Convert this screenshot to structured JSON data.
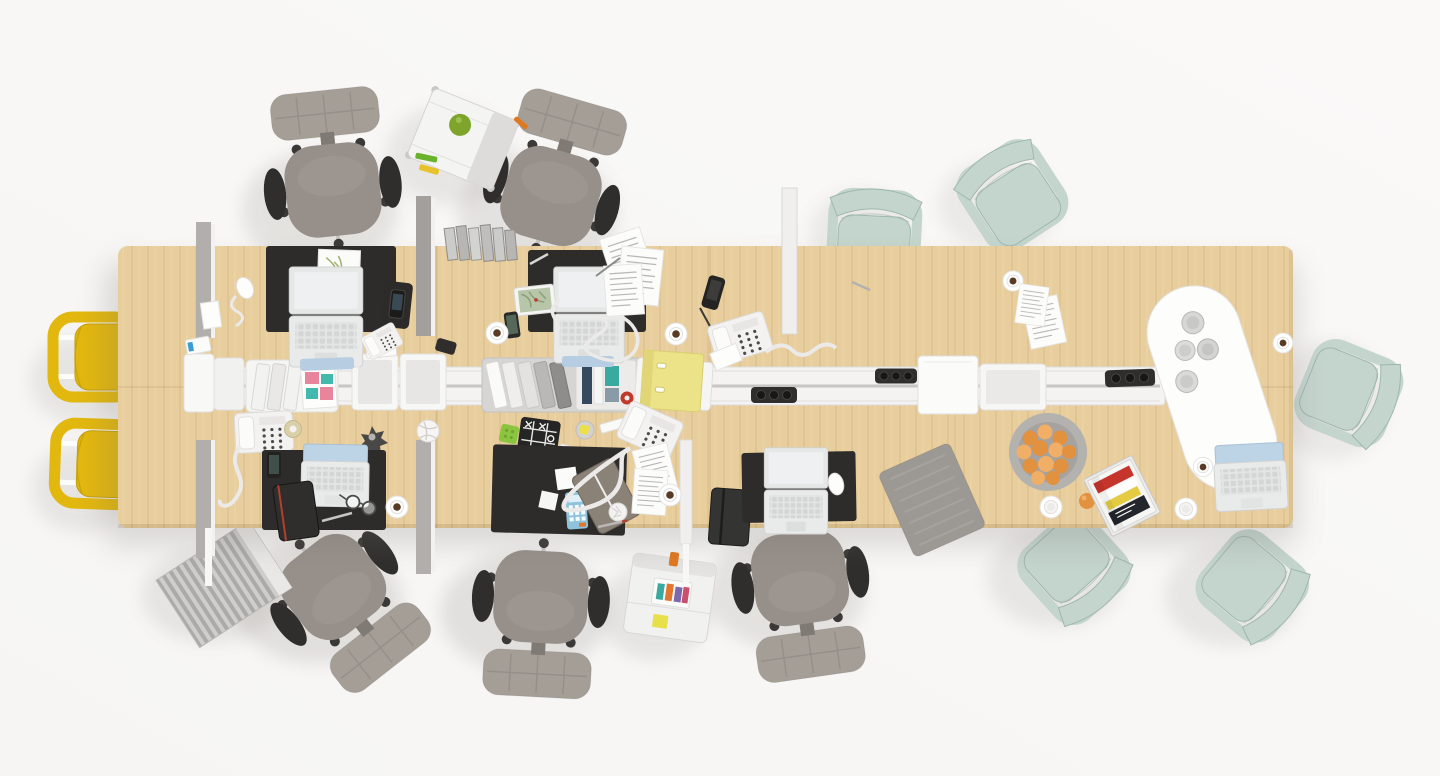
{
  "scene": {
    "title": "Top-down bird's-eye view of a shared office bench desk with chairs and work accessories",
    "style": "photorealistic 3D render, overhead view",
    "desk_material": "light ash wood",
    "floor": "white studio floor"
  },
  "colors": {
    "bg": "#f6f5f3",
    "bgHi": "#faf9f8",
    "wood": "#e8cd9d",
    "woodDark": "#d9ba85",
    "spine": "#f4f3f1",
    "groove": "#c7c6c4",
    "trayGray": "#d6d5d3",
    "dividerGray": "#b1aeab",
    "dividerDark": "#a29f9c",
    "dividerWhite": "#f0efed",
    "mat": "#2d2c2b",
    "chairGray": "#97908a",
    "chairLight": "#a59e97",
    "chairDark": "#2f2e2c",
    "chrome": "#c6c5c3",
    "caster": "#3a3937",
    "yellow": "#e2b70e",
    "yellowDark": "#c49e07",
    "mint": "#c4d5ce",
    "mintDark": "#9fb7af",
    "laptop": "#e9eaea",
    "laptopEdge": "#d2d3d3",
    "screenBlue": "#bdd3e6",
    "screenWhite": "#eef0f1",
    "lip": "#b7cde2",
    "white": "#ffffff",
    "paper": "#fcfcfb",
    "paperLine": "#b9b8b6",
    "folder": "#ece388",
    "folderDark": "#d9ce6e",
    "orange": "#e2913f",
    "orangeHi": "#f0ae66",
    "bowl": "#b4b2af",
    "bowlIn": "#a5a29f",
    "apple": "#7fa42c",
    "cube": "#8bc53f",
    "calc": "#8fc3dc",
    "noteBrown": "#8a8177",
    "noteBlack": "#343433",
    "red": "#c5352b",
    "magYellow": "#e5cb42",
    "magDark": "#23262b",
    "cord": "#ebeae8",
    "coffee": "#5a3a24",
    "padGray": "#9c9893",
    "stripeA": "#cfcecc",
    "stripeB": "#abaaa7",
    "shadow": "#77706a"
  },
  "objects": {
    "desk": "long wooden bench desk with rounded corners and central white cable spine",
    "gray_task_chairs": 5,
    "yellow_side_chairs": 2,
    "mint_plastic_chairs": 5,
    "acoustic_dividers": 6,
    "black_desk_mats": 5,
    "laptops": 5,
    "desk_phones": 4,
    "mobile_phones": 3,
    "coffee_cups": 9,
    "power_modules": 3,
    "trolley_carts": 2,
    "accessories": [
      "ring binders",
      "lever-arch folder (yellow)",
      "document trays",
      "fruit bowl with apricots",
      "oval tray with water glasses",
      "magazine stack",
      "calculator",
      "notebooks",
      "tic-tac-toe game",
      "sticky notes",
      "tape roll",
      "string ball",
      "spiky star toy",
      "green apple",
      "papers",
      "mousepad",
      "striped floor mat",
      "eyeglasses",
      "pens and markers"
    ]
  }
}
